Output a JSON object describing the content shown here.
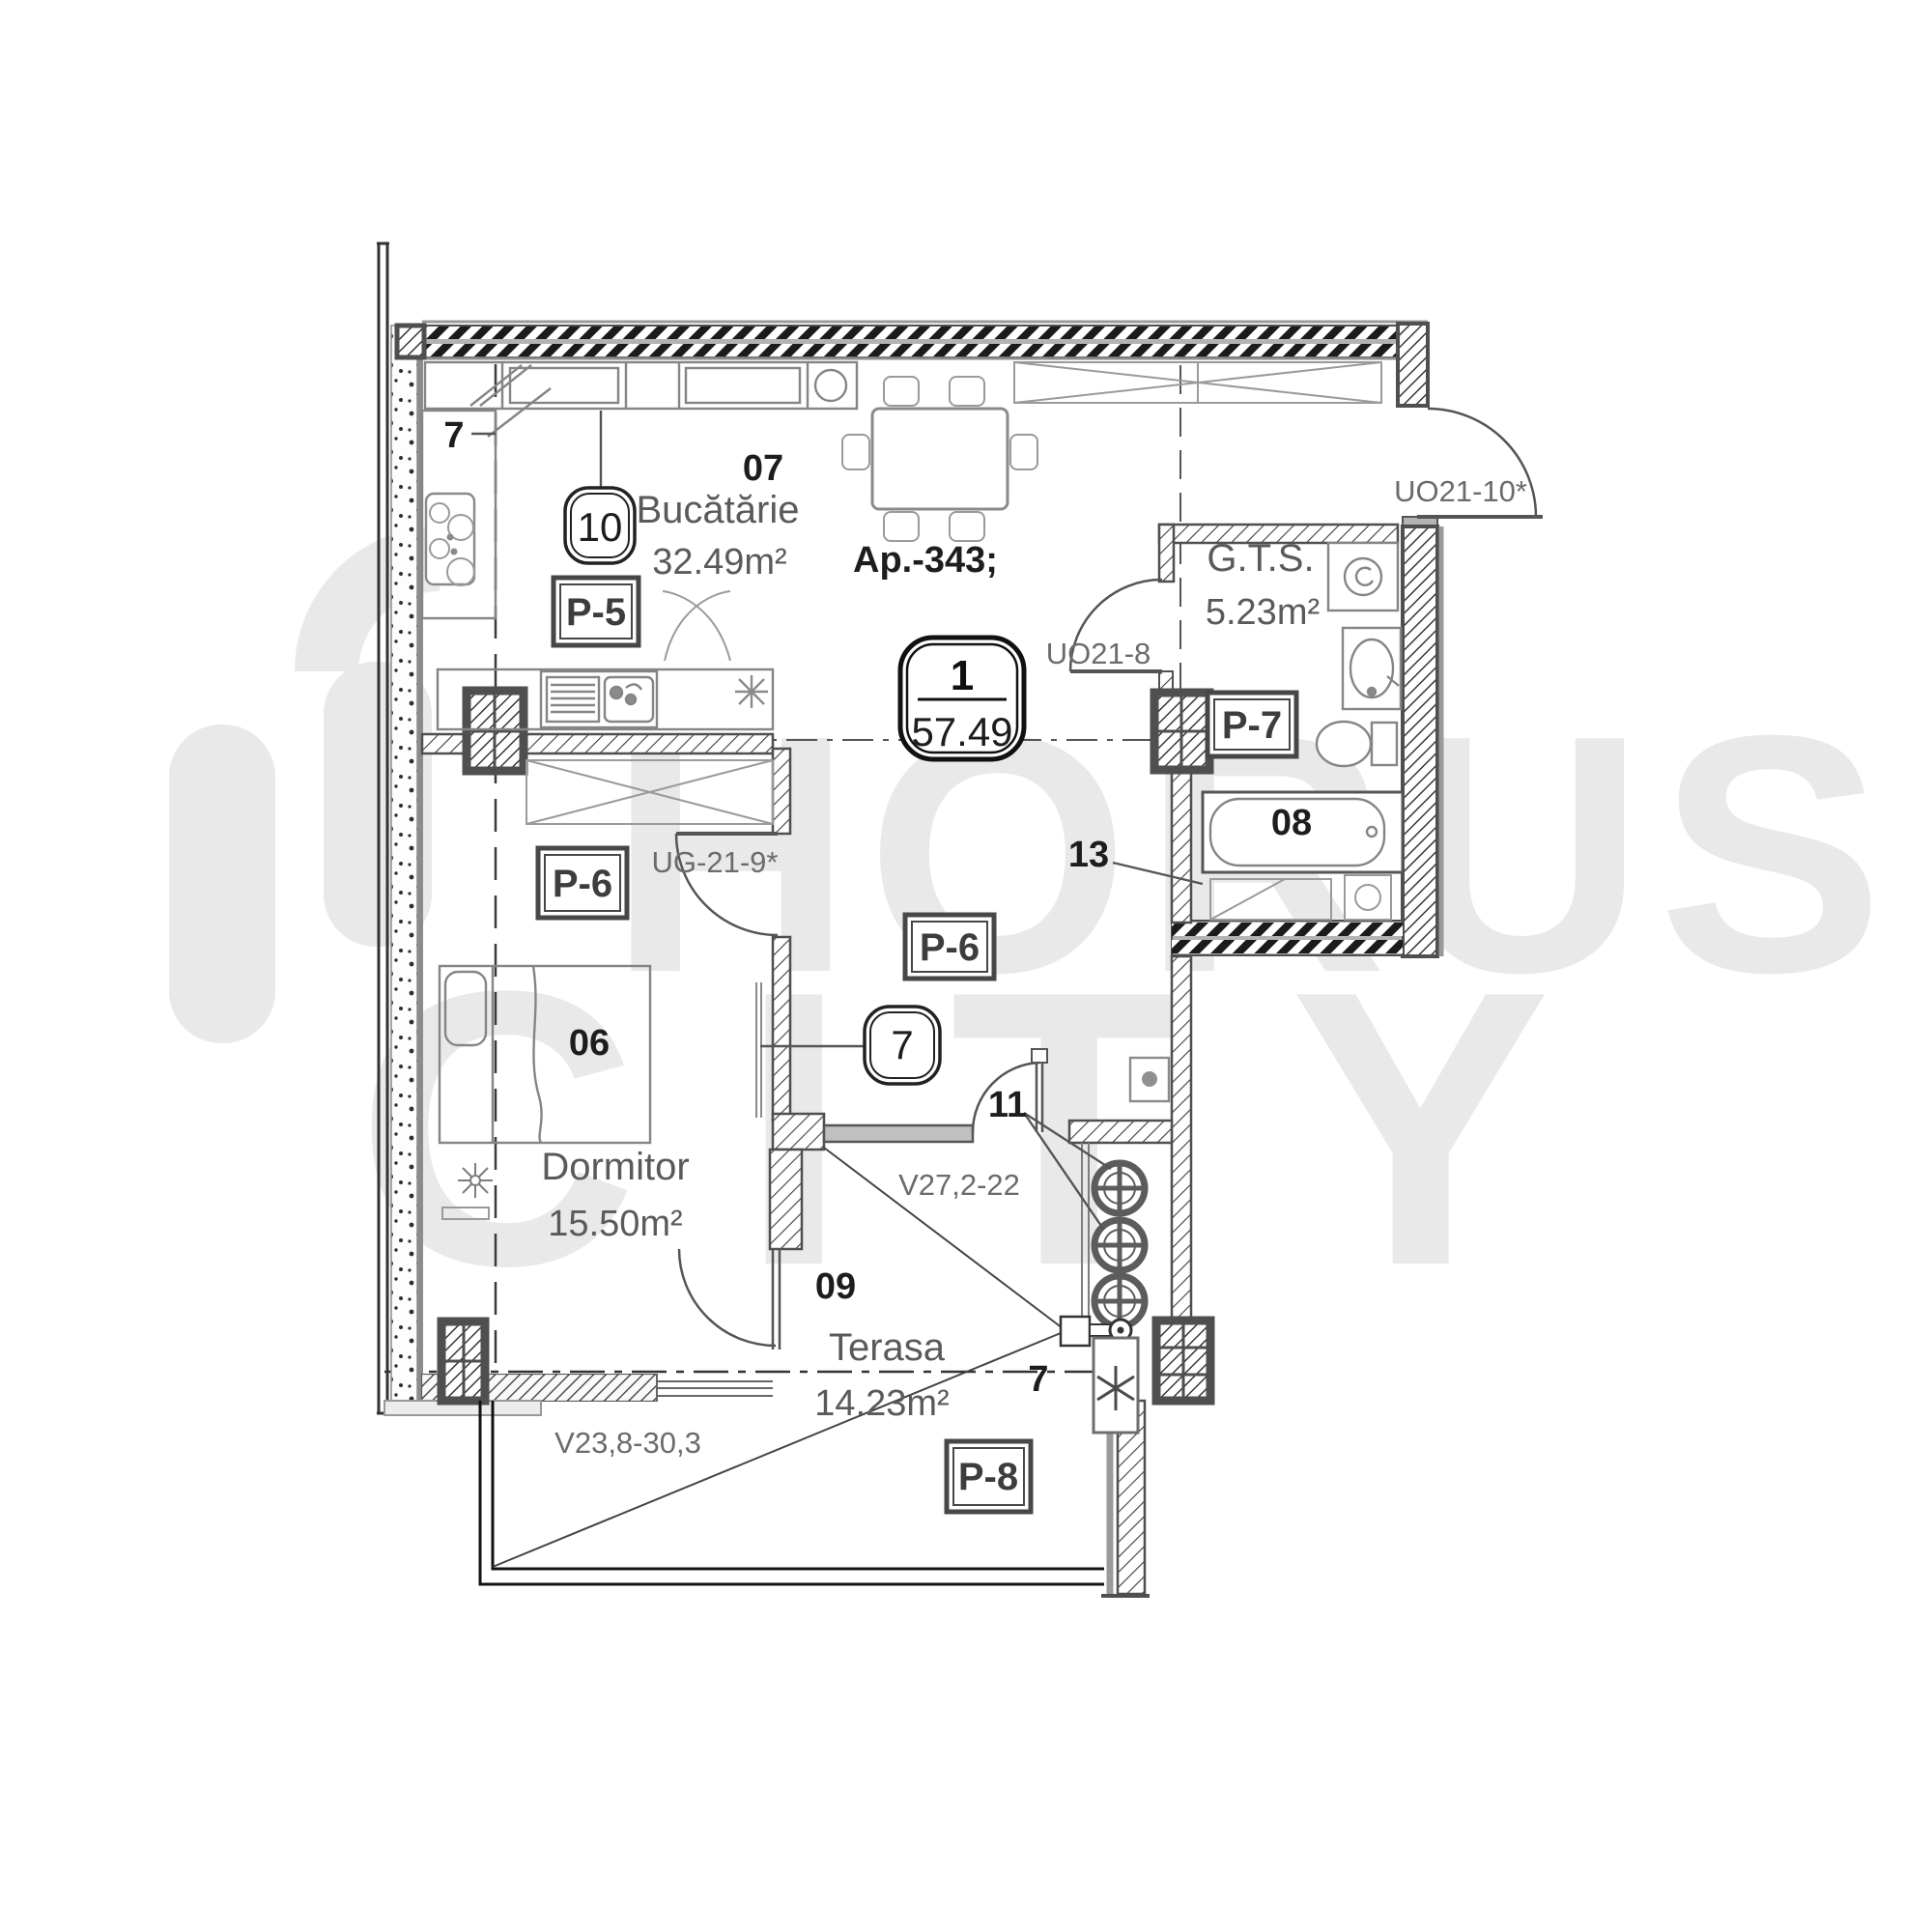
{
  "watermark": {
    "line1": "HORUS",
    "line2": "CITY"
  },
  "apartment": {
    "ref": "Ap.-343;",
    "badge": {
      "number": "1",
      "area": "57.49"
    }
  },
  "rooms": {
    "kitchen": {
      "number": "07",
      "name": "Bucătărie",
      "area": "32.49m²"
    },
    "gts": {
      "name": "G.T.S.",
      "area": "5.23m²"
    },
    "bathroom": {
      "number": "08"
    },
    "bedroom": {
      "number": "06",
      "name": "Dormitor",
      "area": "15.50m²"
    },
    "terrace": {
      "number": "09",
      "name": "Terasa",
      "area": "14.23m²"
    }
  },
  "openings": {
    "entry_door": "UO21-10*",
    "gts_door": "UO21-8",
    "bedroom_door": "UG-21-9*",
    "terrace_window": "V27,2-22",
    "bedroom_window": "V23,8-30,3"
  },
  "finish_tags": {
    "p5": "P-5",
    "p6_left": "P-6",
    "p6_center": "P-6",
    "p7": "P-7",
    "p8": "P-8"
  },
  "markers": {
    "section_top": "7",
    "section_bottom": "7",
    "outlet_badge": "10",
    "hall_badge": "7",
    "vent_label": "11",
    "pipe_label": "13"
  }
}
